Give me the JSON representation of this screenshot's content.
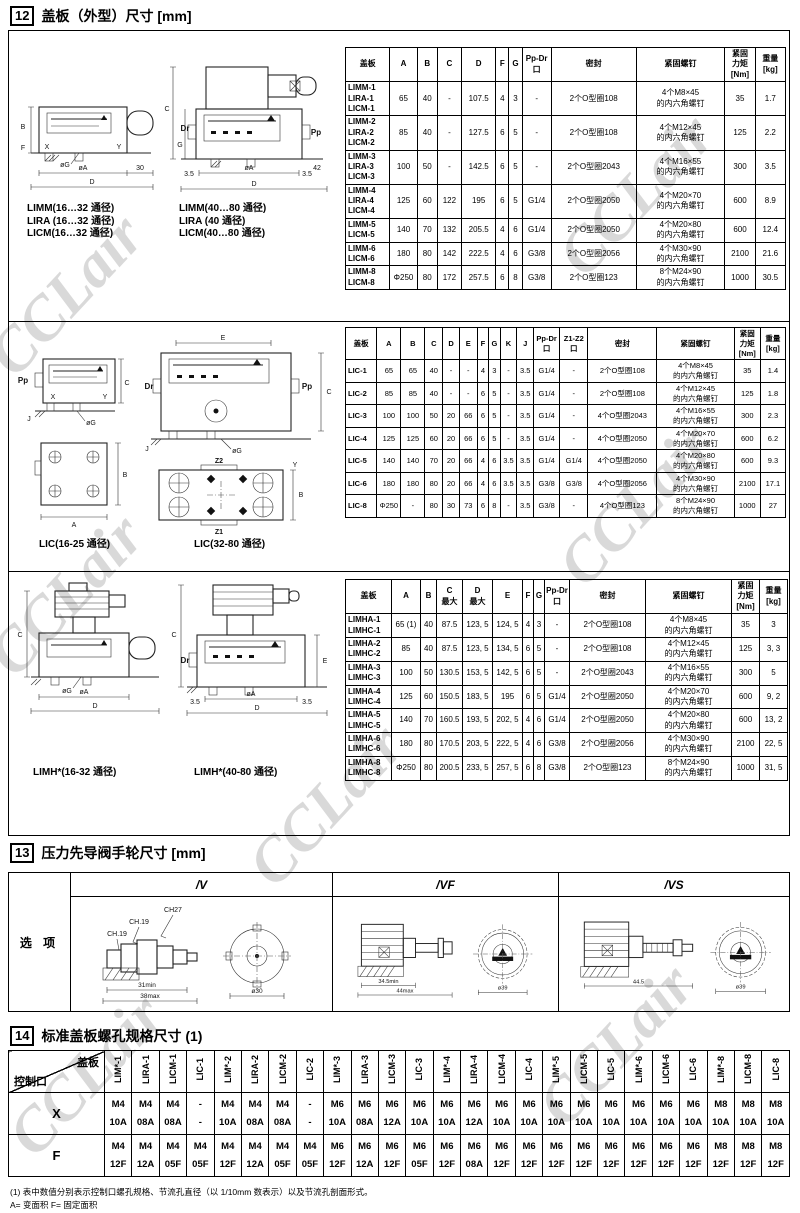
{
  "watermark": "CCLair",
  "s12": {
    "num": "12",
    "title": "盖板（外型）尺寸 [mm]",
    "b1": {
      "labelsL": "LIMM(16…32 通径)\nLIRA (16…32 通径)\nLICM(16…32 通径)",
      "labelsR": "LIMM(40…80 通径)\nLIRA (40 通径)\nLICM(40…80 通径)",
      "annL": [
        "B",
        "X",
        "Y",
        "øG",
        "øA",
        "30",
        "D",
        "F"
      ],
      "annR": [
        "C",
        "G",
        "Dr",
        "Pp",
        "3.5",
        "øA",
        "3.5",
        "42",
        "D"
      ],
      "table": {
        "headers": [
          "盖板",
          "A",
          "B",
          "C",
          "D",
          "F",
          "G",
          "Pp-Dr\n口",
          "密封",
          "紧固螺钉",
          "紧固\n力矩\n[Nm]",
          "重量\n[kg]"
        ],
        "rows": [
          [
            "LIMM-1\nLIRA-1\nLICM-1",
            "65",
            "40",
            "-",
            "107.5",
            "4",
            "3",
            "-",
            "2个O型圈108",
            "4个M8×45\n的内六角螺钉",
            "35",
            "1.7"
          ],
          [
            "LIMM-2\nLIRA-2\nLICM-2",
            "85",
            "40",
            "-",
            "127.5",
            "6",
            "5",
            "-",
            "2个O型圈108",
            "4个M12×45\n的内六角螺钉",
            "125",
            "2.2"
          ],
          [
            "LIMM-3\nLIRA-3\nLICM-3",
            "100",
            "50",
            "-",
            "142.5",
            "6",
            "5",
            "-",
            "2个O型圈2043",
            "4个M16×55\n的内六角螺钉",
            "300",
            "3.5"
          ],
          [
            "LIMM-4\nLIRA-4\nLICM-4",
            "125",
            "60",
            "122",
            "195",
            "6",
            "5",
            "G1/4",
            "2个O型圈2050",
            "4个M20×70\n的内六角螺钉",
            "600",
            "8.9"
          ],
          [
            "LIMM-5\nLICM-5",
            "140",
            "70",
            "132",
            "205.5",
            "4",
            "6",
            "G1/4",
            "2个O型圈2050",
            "4个M20×80\n的内六角螺钉",
            "600",
            "12.4"
          ],
          [
            "LIMM-6\nLICM-6",
            "180",
            "80",
            "142",
            "222.5",
            "4",
            "6",
            "G3/8",
            "2个O型圈2056",
            "4个M30×90\n的内六角螺钉",
            "2100",
            "21.6"
          ],
          [
            "LIMM-8\nLICM-8",
            "Φ250",
            "80",
            "172",
            "257.5",
            "6",
            "8",
            "G3/8",
            "2个O型圈123",
            "8个M24×90\n的内六角螺钉",
            "1000",
            "30.5"
          ]
        ]
      }
    },
    "b2": {
      "labelL": "LIC(16-25 通径)",
      "labelR": "LIC(32-80 通径)",
      "annL": [
        "Pp",
        "C",
        "X",
        "Y",
        "øG",
        "J",
        "A",
        "B"
      ],
      "annR": [
        "E",
        "Dr",
        "Pp",
        "C",
        "øG",
        "J",
        "Z2",
        "Z1",
        "B",
        "Y"
      ],
      "table": {
        "headers": [
          "盖板",
          "A",
          "B",
          "C",
          "D",
          "E",
          "F",
          "G",
          "K",
          "J",
          "Pp-Dr\n口",
          "Z1-Z2\n口",
          "密封",
          "紧固螺钉",
          "紧固\n力矩\n[Nm]",
          "重量\n[kg]"
        ],
        "rows": [
          [
            "LIC-1",
            "65",
            "65",
            "40",
            "-",
            "-",
            "4",
            "3",
            "-",
            "3.5",
            "G1/4",
            "-",
            "2个O型圈108",
            "4个M8×45\n的内六角螺钉",
            "35",
            "1.4"
          ],
          [
            "LIC-2",
            "85",
            "85",
            "40",
            "-",
            "-",
            "6",
            "5",
            "-",
            "3.5",
            "G1/4",
            "-",
            "2个O型圈108",
            "4个M12×45\n的内六角螺钉",
            "125",
            "1.8"
          ],
          [
            "LIC-3",
            "100",
            "100",
            "50",
            "20",
            "66",
            "6",
            "5",
            "-",
            "3.5",
            "G1/4",
            "-",
            "4个O型圈2043",
            "4个M16×55\n的内六角螺钉",
            "300",
            "2.3"
          ],
          [
            "LIC-4",
            "125",
            "125",
            "60",
            "20",
            "66",
            "6",
            "5",
            "-",
            "3.5",
            "G1/4",
            "-",
            "4个O型圈2050",
            "4个M20×70\n的内六角螺钉",
            "600",
            "6.2"
          ],
          [
            "LIC-5",
            "140",
            "140",
            "70",
            "20",
            "66",
            "4",
            "6",
            "3.5",
            "3.5",
            "G1/4",
            "G1/4",
            "4个O型圈2050",
            "4个M20×80\n的内六角螺钉",
            "600",
            "9.3"
          ],
          [
            "LIC-6",
            "180",
            "180",
            "80",
            "20",
            "66",
            "4",
            "6",
            "3.5",
            "3.5",
            "G3/8",
            "G3/8",
            "4个O型圈2056",
            "4个M30×90\n的内六角螺钉",
            "2100",
            "17.1"
          ],
          [
            "LIC-8",
            "Φ250",
            "-",
            "80",
            "30",
            "73",
            "6",
            "8",
            "-",
            "3.5",
            "G3/8",
            "-",
            "4个O型圈123",
            "8个M24×90\n的内六角螺钉",
            "1000",
            "27"
          ]
        ]
      }
    },
    "b3": {
      "labelL": "LIMH*(16-32 通径)",
      "labelR": "LIMH*(40-80 通径)",
      "annL": [
        "C",
        "øG",
        "øA",
        "D"
      ],
      "annR": [
        "C",
        "Dr",
        "3.5",
        "øA",
        "3.5",
        "D",
        "E"
      ],
      "table": {
        "headers": [
          "盖板",
          "A",
          "B",
          "C\n最大",
          "D\n最大",
          "E",
          "F",
          "G",
          "Pp-Dr\n口",
          "密封",
          "紧固螺钉",
          "紧固\n力矩\n[Nm]",
          "重量\n[kg]"
        ],
        "rows": [
          [
            "LIMHA-1\nLIMHC-1",
            "65 (1)",
            "40",
            "87.5",
            "123, 5",
            "124, 5",
            "4",
            "3",
            "-",
            "2个O型圈108",
            "4个M8×45\n的内六角螺钉",
            "35",
            "3"
          ],
          [
            "LIMHA-2\nLIMHC-2",
            "85",
            "40",
            "87.5",
            "123, 5",
            "134, 5",
            "6",
            "5",
            "-",
            "2个O型圈108",
            "4个M12×45\n的内六角螺钉",
            "125",
            "3, 3"
          ],
          [
            "LIMHA-3\nLIMHC-3",
            "100",
            "50",
            "130.5",
            "153, 5",
            "142, 5",
            "6",
            "5",
            "-",
            "2个O型圈2043",
            "4个M16×55\n的内六角螺钉",
            "300",
            "5"
          ],
          [
            "LIMHA-4\nLIMHC-4",
            "125",
            "60",
            "150.5",
            "183, 5",
            "195",
            "6",
            "5",
            "G1/4",
            "2个O型圈2050",
            "4个M20×70\n的内六角螺钉",
            "600",
            "9, 2"
          ],
          [
            "LIMHA-5\nLIMHC-5",
            "140",
            "70",
            "160.5",
            "193, 5",
            "202, 5",
            "4",
            "6",
            "G1/4",
            "2个O型圈2050",
            "4个M20×80\n的内六角螺钉",
            "600",
            "13, 2"
          ],
          [
            "LIMHA-6\nLIMHC-6",
            "180",
            "80",
            "170.5",
            "203, 5",
            "222, 5",
            "4",
            "6",
            "G3/8",
            "2个O型圈2056",
            "4个M30×90\n的内六角螺钉",
            "2100",
            "22, 5"
          ],
          [
            "LIMHA-8\nLIMHC-8",
            "Φ250",
            "80",
            "200.5",
            "233, 5",
            "257, 5",
            "6",
            "8",
            "G3/8",
            "2个O型圈123",
            "8个M24×90\n的内六角螺钉",
            "1000",
            "31, 5"
          ]
        ]
      }
    }
  },
  "s13": {
    "num": "13",
    "title": "压力先导阀手轮尺寸 [mm]",
    "row_label": "选 项",
    "v": {
      "label": "/V",
      "ann": [
        "CH27",
        "CH.19",
        "CH.19",
        "31min",
        "38max",
        "ø30"
      ]
    },
    "vf": {
      "label": "/VF",
      "ann": [
        "34.5min",
        "44max",
        "ø39"
      ]
    },
    "vs": {
      "label": "/VS",
      "ann": [
        "44.5",
        "ø39"
      ]
    }
  },
  "s14": {
    "num": "14",
    "title": "标准盖板螺孔规格尺寸 (1)",
    "corner_top": "盖板",
    "corner_bottom": "控制口",
    "columns": [
      "LIM*-1",
      "LIRA-1",
      "LICM-1",
      "LIC-1",
      "LIM*-2",
      "LIRA-2",
      "LICM-2",
      "LIC-2",
      "LIM*-3",
      "LIRA-3",
      "LICM-3",
      "LIC-3",
      "LIM*-4",
      "LIRA-4",
      "LICM-4",
      "LIC-4",
      "LIM*-5",
      "LICM-5",
      "LIC-5",
      "LIM*-6",
      "LICM-6",
      "LIC-6",
      "LIM*-8",
      "LICM-8",
      "LIC-8"
    ],
    "rows": [
      {
        "label": "X",
        "cells": [
          [
            "M4",
            "10A"
          ],
          [
            "M4",
            "08A"
          ],
          [
            "M4",
            "08A"
          ],
          [
            "-",
            "-"
          ],
          [
            "M4",
            "10A"
          ],
          [
            "M4",
            "08A"
          ],
          [
            "M4",
            "08A"
          ],
          [
            "-",
            "-"
          ],
          [
            "M6",
            "10A"
          ],
          [
            "M6",
            "08A"
          ],
          [
            "M6",
            "12A"
          ],
          [
            "M6",
            "10A"
          ],
          [
            "M6",
            "10A"
          ],
          [
            "M6",
            "12A"
          ],
          [
            "M6",
            "10A"
          ],
          [
            "M6",
            "10A"
          ],
          [
            "M6",
            "10A"
          ],
          [
            "M6",
            "10A"
          ],
          [
            "M6",
            "10A"
          ],
          [
            "M6",
            "10A"
          ],
          [
            "M6",
            "10A"
          ],
          [
            "M6",
            "10A"
          ],
          [
            "M8",
            "10A"
          ],
          [
            "M8",
            "10A"
          ],
          [
            "M8",
            "10A"
          ]
        ]
      },
      {
        "label": "F",
        "cells": [
          [
            "M4",
            "12F"
          ],
          [
            "M4",
            "12A"
          ],
          [
            "M4",
            "05F"
          ],
          [
            "M4",
            "05F"
          ],
          [
            "M4",
            "12F"
          ],
          [
            "M4",
            "12A"
          ],
          [
            "M4",
            "05F"
          ],
          [
            "M4",
            "05F"
          ],
          [
            "M6",
            "12F"
          ],
          [
            "M6",
            "12A"
          ],
          [
            "M6",
            "12F"
          ],
          [
            "M6",
            "05F"
          ],
          [
            "M6",
            "12F"
          ],
          [
            "M6",
            "08A"
          ],
          [
            "M6",
            "12F"
          ],
          [
            "M6",
            "12F"
          ],
          [
            "M6",
            "12F"
          ],
          [
            "M6",
            "12F"
          ],
          [
            "M6",
            "12F"
          ],
          [
            "M6",
            "12F"
          ],
          [
            "M6",
            "12F"
          ],
          [
            "M6",
            "12F"
          ],
          [
            "M8",
            "12F"
          ],
          [
            "M8",
            "12F"
          ],
          [
            "M8",
            "12F"
          ]
        ]
      }
    ],
    "footnote": "(1) 表中数值分别表示控制口螺孔规格、节流孔直径（以 1/10mm 数表示）以及节流孔剖面形式。\n    A= 变面积      F= 固定面积"
  }
}
